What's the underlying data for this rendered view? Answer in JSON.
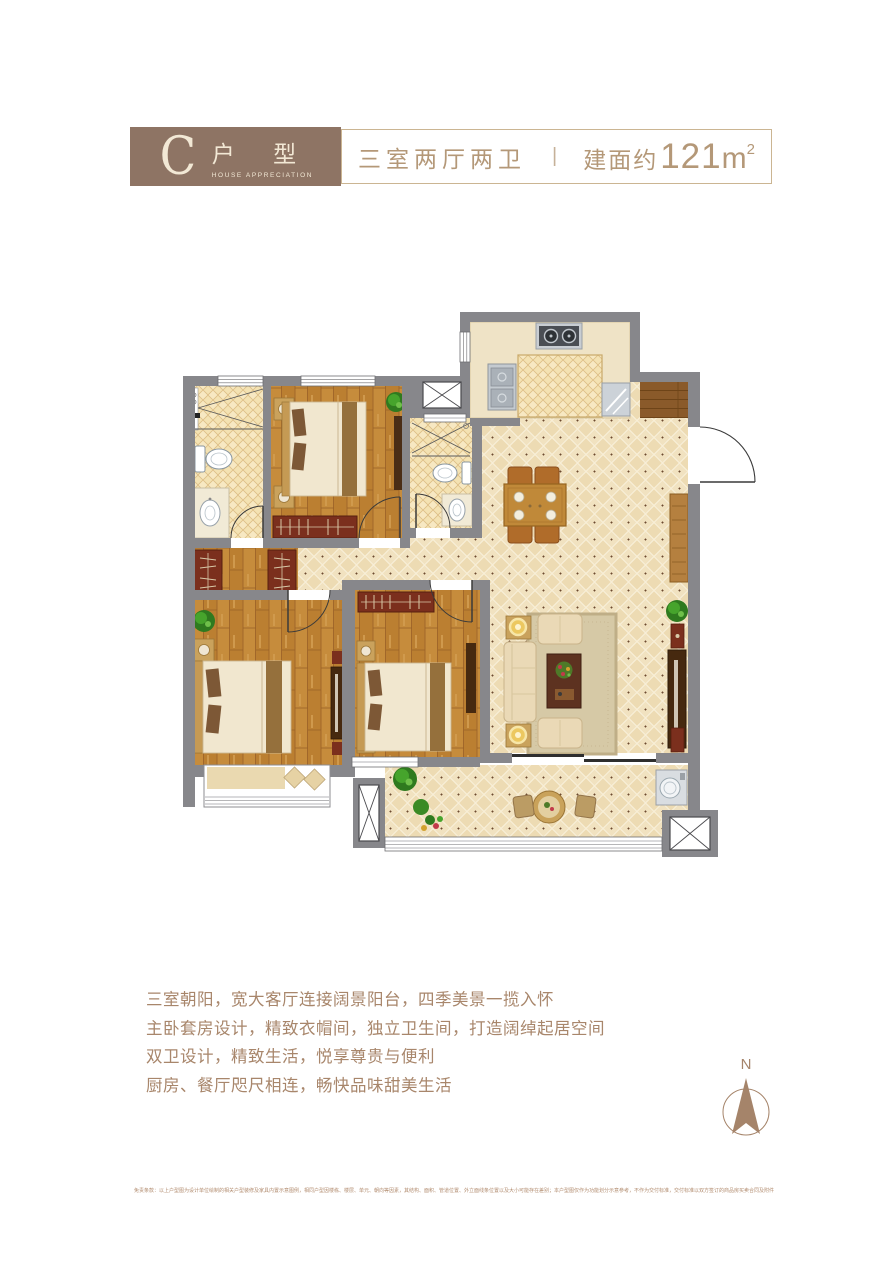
{
  "header": {
    "badge": {
      "letter": "C",
      "label": "户 型",
      "sublabel": "HOUSE APPRECIATION",
      "bg": "#8e7464",
      "text_color": "#f2e8d5"
    },
    "spec": {
      "rooms": "三室两厅两卫",
      "divider": "|",
      "area_prefix": "建面约",
      "area_value": "121",
      "area_unit": "m",
      "area_sup": "2",
      "color": "#b49878",
      "border_color": "#cbb592"
    }
  },
  "features": {
    "color": "#a8866b",
    "lines": [
      "三室朝阳，宽大客厅连接阔景阳台，四季美景一揽入怀",
      "主卧套房设计，精致衣帽间，独立卫生间，打造阔绰起居空间",
      "双卫设计，精致生活，悦享尊贵与便利",
      "厨房、餐厅咫尺相连，畅快品味甜美生活"
    ]
  },
  "compass": {
    "label": "N",
    "color": "#a5846a"
  },
  "disclaimer": {
    "color": "#b28c6f",
    "text": "免责条款：以上户型图为设计单位绘制的相关户型装修及家具内置示意图例，相同户型因楼栋、楼层、单元、朝向等因素，其结构、面积、管道位置、外立面线条位置以及大小可能存在差别；本户型图仅作为功能划分示意参考，不作为交付标准，交付标准以双方签订的商品房买卖合同及附件约定为准。"
  },
  "floorplan": {
    "wall_color": "#87878b",
    "tile_color": "#eddbb3",
    "wood_color": "#c68c3c",
    "wardrobe_color": "#7b2f1d",
    "rooms": [
      "living-dining-room",
      "kitchen",
      "entry",
      "master-bedroom",
      "bedroom-2",
      "bedroom-3",
      "bathroom-1",
      "bathroom-2",
      "walk-in-closet",
      "balcony"
    ]
  }
}
